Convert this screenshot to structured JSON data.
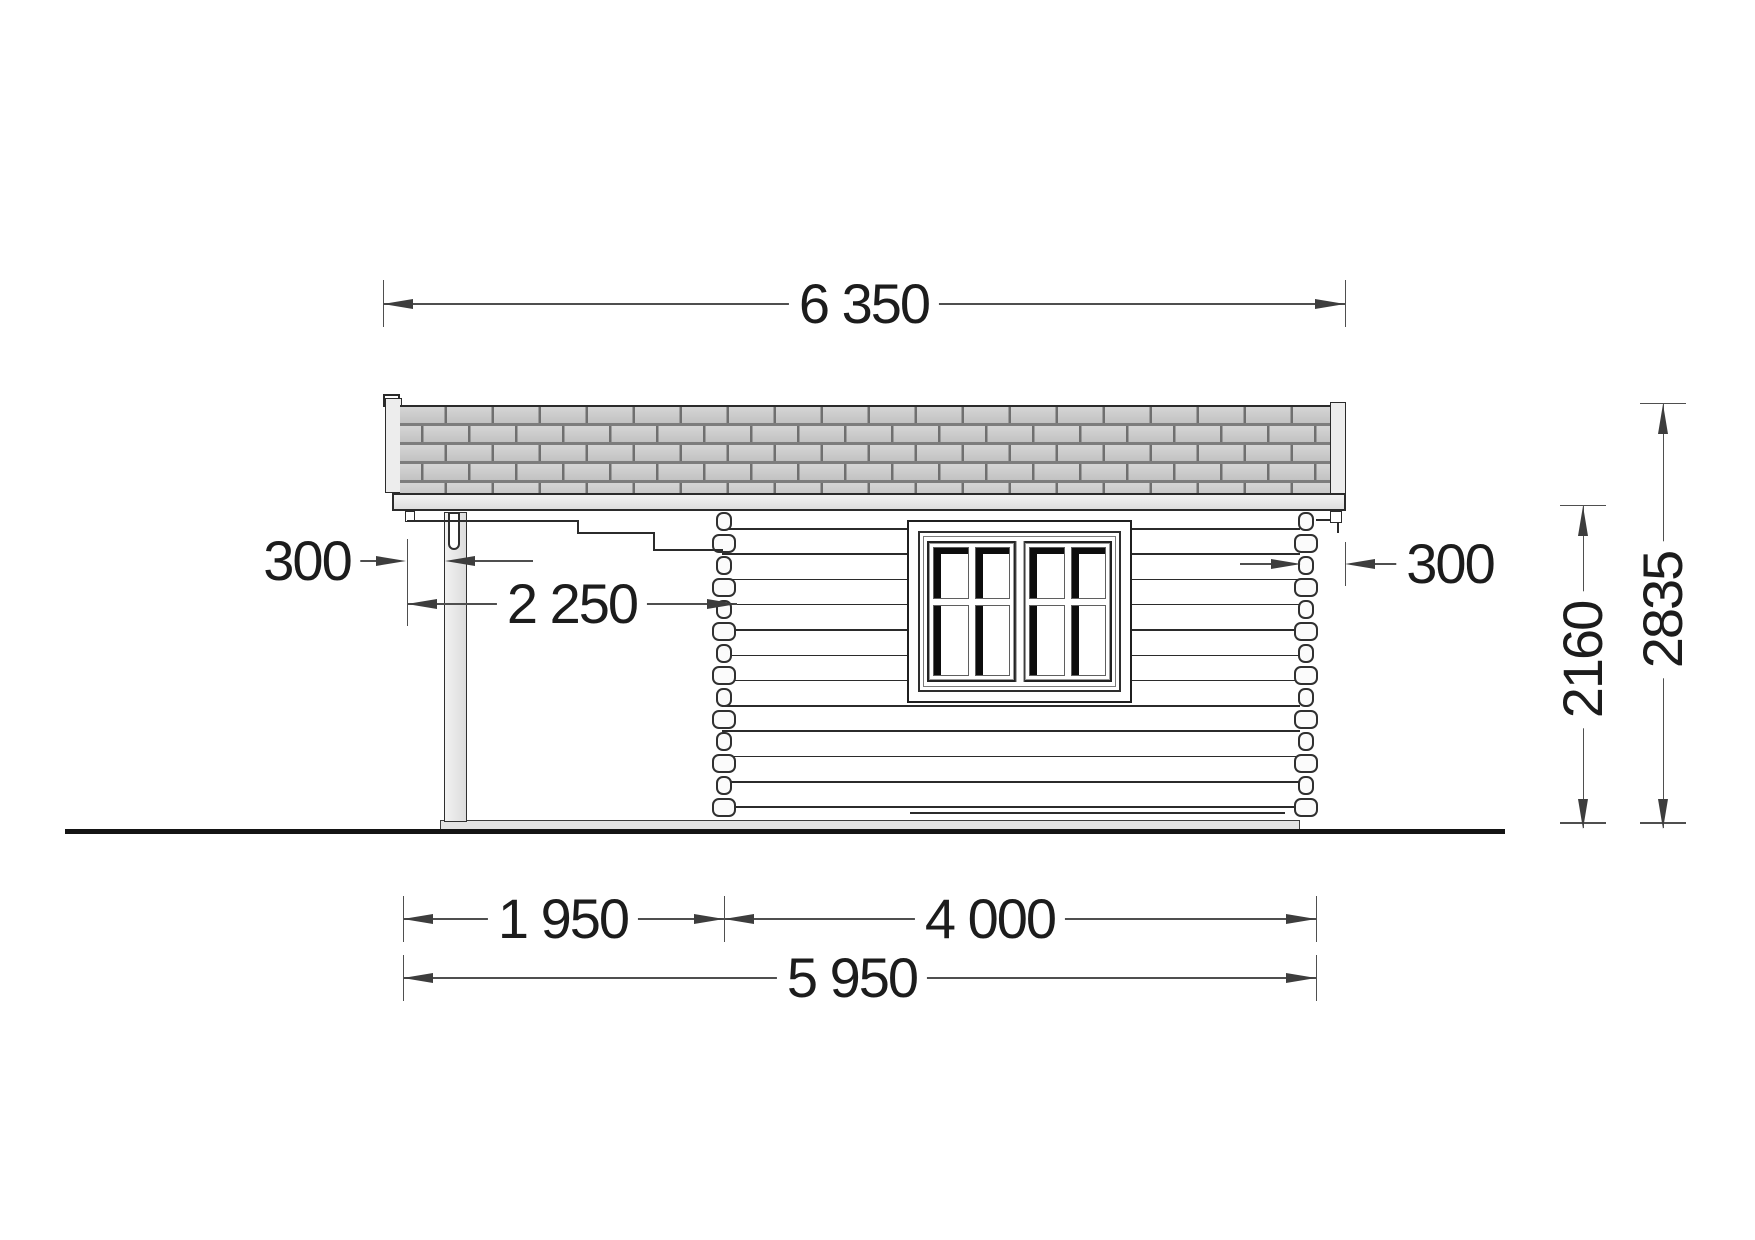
{
  "drawing": {
    "view": "side elevation",
    "subject": "log cabin with side canopy and post",
    "units": "mm"
  },
  "dimensions": {
    "roof_length": {
      "label": "6 350"
    },
    "overhang_left": {
      "label": "300"
    },
    "overhang_right": {
      "label": "300"
    },
    "canopy_depth": {
      "label": "2 250"
    },
    "terrace_width": {
      "label": "1 950"
    },
    "cabin_width": {
      "label": "4 000"
    },
    "base_total": {
      "label": "5 950"
    },
    "wall_height": {
      "label": "2160"
    },
    "total_height": {
      "label": "2835"
    }
  },
  "colors": {
    "line": "#2b2b2b",
    "dim_line": "#4f4f4f",
    "dim_text": "#1c1c1c",
    "shingle_fill": "#c9c9c9",
    "shingle_joint": "#6f6f6f",
    "trim_fill": "#ededed",
    "slab_fill": "#e2e2e2",
    "glass_shadow": "#0d0d0d",
    "ground": "#141414",
    "background": "#ffffff"
  }
}
